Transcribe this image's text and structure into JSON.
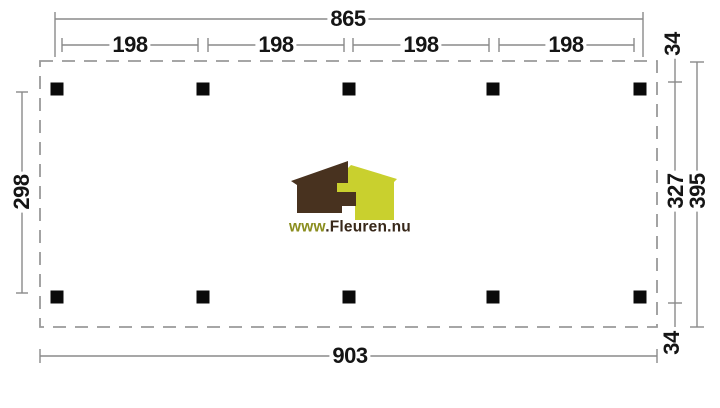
{
  "drawing": {
    "top_total_width": "865",
    "bay_widths": [
      "198",
      "198",
      "198",
      "198"
    ],
    "bottom_total_width": "903",
    "left_depth": "298",
    "right_overhang_top": "34",
    "right_inner_depth": "327",
    "right_total_depth": "395",
    "right_overhang_bottom": "34"
  },
  "logo": {
    "url_prefix": "www",
    "url_suffix": ".Fleuren.nu"
  },
  "colors": {
    "logo_house_dark": "#48321f",
    "logo_house_light": "#c9d02e",
    "logo_url_prefix": "#8b8e1f",
    "logo_url_suffix": "#38281a",
    "line_gray": "#8a8a8a",
    "outline_gray": "#999999",
    "post_black": "#0a0a0a"
  }
}
